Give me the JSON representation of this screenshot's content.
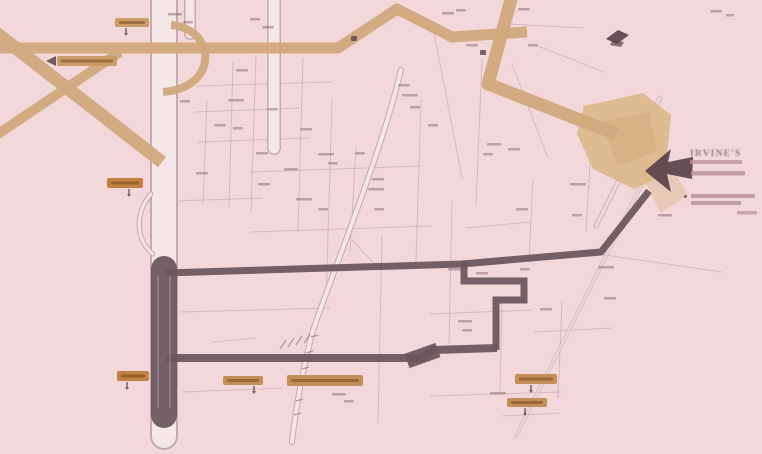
{
  "meta": {
    "type": "real-estate-location-map",
    "width": 762,
    "height": 454
  },
  "palette": {
    "background": "#f2d8da",
    "tan_road": "#d1a97d",
    "tan_area": "#dcb98c",
    "tan_area_dark": "#d3ab7a",
    "pale_road_edge": "#c6a8b1",
    "pale_road_fill": "#f5e7e7",
    "street": "#bfa0ab",
    "railway": "#a28295",
    "route": "#6b555c",
    "marker": "#5a434a",
    "micro_label": "#7d5a69",
    "pill_tan": "#c79a63",
    "pill_orange": "#bf7b3b",
    "pill_wide": "#c08a52",
    "pill_text": "#6d4416",
    "legend_text": "#8d666c",
    "legend_bar": "#b9949c"
  },
  "legend": {
    "title": "IRVINE'S",
    "legible": false,
    "subtitle_bar": [
      690,
      160,
      52,
      4
    ],
    "bullet1": [
      684,
      172,
      3,
      3
    ],
    "bar1": [
      691,
      171,
      54,
      4.5
    ],
    "bullet2": [
      684,
      195,
      3,
      3
    ],
    "bar2a": [
      691,
      194,
      64,
      4
    ],
    "bar2b": [
      691,
      201,
      50,
      4
    ],
    "note_bar": [
      737,
      211,
      20,
      3.5
    ]
  },
  "road_labels": [
    {
      "text": "",
      "legible": false,
      "x": 115,
      "y": 18,
      "w": 34,
      "h": 9,
      "variant": "tan",
      "pointer": "stem",
      "px": 126
    },
    {
      "text": "",
      "legible": false,
      "x": 57,
      "y": 56,
      "w": 60,
      "h": 10,
      "variant": "tan",
      "pointer": "arrow",
      "px": 50
    },
    {
      "text": "",
      "legible": false,
      "x": 107,
      "y": 178,
      "w": 36,
      "h": 10,
      "variant": "orange",
      "pointer": "stem",
      "px": 129
    },
    {
      "text": "",
      "legible": false,
      "x": 117,
      "y": 371,
      "w": 32,
      "h": 10,
      "variant": "orange",
      "pointer": "stem",
      "px": 127
    },
    {
      "text": "",
      "legible": false,
      "x": 223,
      "y": 376,
      "w": 40,
      "h": 9,
      "variant": "wide",
      "pointer": "stem",
      "px": 254
    },
    {
      "text": "",
      "legible": false,
      "x": 287,
      "y": 375,
      "w": 76,
      "h": 11,
      "variant": "wide",
      "pointer": "none",
      "px": 0
    },
    {
      "text": "",
      "legible": false,
      "x": 515,
      "y": 374,
      "w": 42,
      "h": 10,
      "variant": "wide",
      "pointer": "stem",
      "px": 531
    },
    {
      "text": "",
      "legible": false,
      "x": 507,
      "y": 398,
      "w": 40,
      "h": 9,
      "variant": "wide",
      "pointer": "stem",
      "px": 525
    }
  ],
  "geometry": {
    "streets": [
      "207,100 203,205",
      "233,62 229,207",
      "256,55 251,212",
      "303,58 298,232",
      "332,100 326,302",
      "356,148 350,252",
      "382,236 378,424",
      "421,100 416,262",
      "452,200 449,344",
      "482,60 476,205",
      "502,302 500,392",
      "533,180 529,260",
      "562,302 558,398",
      "592,128 586,232",
      "432,22 462,178",
      "512,64 548,158",
      "538,46 604,72",
      "196,86 332,82",
      "194,112 300,108",
      "198,142 310,138",
      "250,172 420,166",
      "146,202 262,198",
      "250,232 432,226",
      "180,312 330,308",
      "430,314 532,310",
      "534,332 612,328",
      "182,392 282,388",
      "430,396 562,392",
      "502,416 560,413",
      "598,254 722,272",
      "508,24 584,28",
      "212,342 256,338",
      "466,228 530,222",
      "352,240 380,270"
    ],
    "pale_roads": [
      {
        "d": "M164,-6 L164,436",
        "o": 28,
        "i": 24,
        "op": 1
      },
      {
        "d": "M190,-6 L190,34",
        "o": 12,
        "i": 9,
        "op": 1
      },
      {
        "d": "M274,-6 L274,148",
        "o": 14,
        "i": 11,
        "op": 1
      },
      {
        "d": "M401,70 C382,150 342,248 313,330 C302,372 296,406 292,442",
        "o": 6,
        "i": 4,
        "op": 1
      },
      {
        "d": "M151,194 C135,212 135,240 153,254",
        "o": 5,
        "i": 3,
        "op": 1
      },
      {
        "d": "M660,98 L596,226",
        "o": 5,
        "i": 3,
        "op": 0.75
      },
      {
        "d": "M642,184 L516,436",
        "o": 4,
        "i": 2.5,
        "op": 0.6
      }
    ],
    "tan_roads": [
      {
        "d": "M-10,28 L162,162",
        "w": 13
      },
      {
        "d": "M-8,138 L120,52",
        "w": 10
      },
      {
        "d": "M-10,48 L338,48 L397,9 L452,37 L527,32",
        "w": 11
      },
      {
        "d": "M513,-8 L488,84 L616,134",
        "w": 13
      },
      {
        "d": "M171,25 C217,29 219,88 163,92",
        "w": 8
      }
    ],
    "tan_areas": [
      {
        "points": "584,106 643,93 671,115 665,175 634,189 593,169 577,134",
        "fill": "tan_area",
        "op": 0.95
      },
      {
        "points": "600,122 649,112 657,152 618,166",
        "fill": "tan_area_dark",
        "op": 0.55
      },
      {
        "points": "640,172 666,158 688,195 661,213",
        "fill": "tan_area",
        "op": 0.45
      }
    ],
    "railway_ticks": [
      "311,337 318,335",
      "306,353 313,351",
      "302,369 309,367",
      "299,385 306,383",
      "296,401 303,399",
      "294,415 301,413",
      "280,349 286,340",
      "288,347 294,338",
      "296,345 302,336",
      "304,343 310,334"
    ],
    "route": [
      {
        "d": "M164,269 L164,415",
        "w": 26,
        "cap": "round",
        "join": "round"
      },
      {
        "d": "M165,273 L462,264 L601,252 L649,191",
        "w": 7,
        "cap": "butt",
        "join": "round"
      },
      {
        "d": "M464,261 L464,281 L524,281 L524,300 L496,300 L496,350",
        "w": 7,
        "cap": "butt",
        "join": "miter"
      },
      {
        "d": "M497,348 L434,350 L421,358 L166,358",
        "w": 8,
        "cap": "butt",
        "join": "miter"
      },
      {
        "d": "M438,350 L407,361",
        "w": 15,
        "cap": "butt",
        "join": "miter"
      }
    ],
    "route_lane_lines": [
      {
        "d": "M158,276 L158,408",
        "w": 1.3
      },
      {
        "d": "M170,276 L170,408",
        "w": 1.3
      }
    ],
    "destination_arrow": "645,171 671,149 668,162 693,157 692,179 667,174 671,192",
    "station_icon": [
      {
        "points": "606,39 618,30 629,35 617,44",
        "op": 0.9
      },
      {
        "points": "610,45 621,47 624,42 613,40",
        "op": 0.7
      }
    ],
    "poi_dots": [
      [
        351,
        36,
        6,
        5
      ],
      [
        480,
        50,
        6,
        5
      ]
    ],
    "label_arrow": "46,61 56,56 56,66",
    "micro_labels": [
      [
        168,
        13,
        14
      ],
      [
        183,
        21,
        10
      ],
      [
        236,
        69,
        12
      ],
      [
        228,
        99,
        16
      ],
      [
        214,
        124,
        12
      ],
      [
        233,
        127,
        10
      ],
      [
        256,
        152,
        12
      ],
      [
        284,
        168,
        14
      ],
      [
        318,
        153,
        16
      ],
      [
        328,
        162,
        10
      ],
      [
        258,
        183,
        12
      ],
      [
        296,
        198,
        16
      ],
      [
        318,
        208,
        10
      ],
      [
        372,
        178,
        12
      ],
      [
        368,
        188,
        16
      ],
      [
        374,
        208,
        10
      ],
      [
        398,
        84,
        12
      ],
      [
        402,
        94,
        16
      ],
      [
        428,
        124,
        10
      ],
      [
        487,
        143,
        14
      ],
      [
        483,
        153,
        10
      ],
      [
        508,
        148,
        12
      ],
      [
        570,
        183,
        16
      ],
      [
        516,
        208,
        12
      ],
      [
        572,
        214,
        10
      ],
      [
        598,
        266,
        16
      ],
      [
        604,
        297,
        12
      ],
      [
        458,
        320,
        14
      ],
      [
        462,
        329,
        10
      ],
      [
        540,
        308,
        12
      ],
      [
        332,
        393,
        14
      ],
      [
        344,
        400,
        10
      ],
      [
        442,
        12,
        12
      ],
      [
        456,
        9,
        10
      ],
      [
        518,
        8,
        12
      ],
      [
        528,
        44,
        10
      ],
      [
        466,
        44,
        12
      ],
      [
        250,
        18,
        10
      ],
      [
        262,
        26,
        12
      ],
      [
        410,
        106,
        10
      ],
      [
        355,
        152,
        10
      ],
      [
        300,
        128,
        12
      ],
      [
        268,
        108,
        10
      ],
      [
        180,
        100,
        10
      ],
      [
        196,
        172,
        12
      ],
      [
        490,
        392,
        16
      ],
      [
        520,
        268,
        10
      ],
      [
        476,
        272,
        12
      ],
      [
        448,
        268,
        14
      ],
      [
        658,
        214,
        14
      ],
      [
        710,
        10,
        12
      ],
      [
        726,
        14,
        8
      ]
    ]
  }
}
